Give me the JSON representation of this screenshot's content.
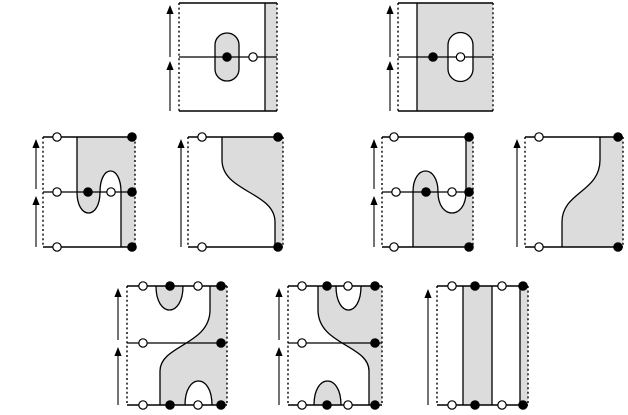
{
  "figure": {
    "title": "cobordism-diagram-figure",
    "canvas": {
      "width": 628,
      "height": 415
    },
    "colors": {
      "background": "#ffffff",
      "shade": "#dcdcdc",
      "stroke": "#000000",
      "open_dot_fill": "#ffffff",
      "filled_dot_fill": "#000000"
    },
    "style": {
      "edge_stroke_width": 1.4,
      "curve_stroke_width": 1.3,
      "dash_pattern": "2 2.6",
      "dot_radius": 4.2,
      "dot_stroke_width": 1.2,
      "arrow_stroke_width": 1.1,
      "arrow_head_half_width": 3.6,
      "arrow_head_length": 9
    },
    "panels": [
      {
        "name": "panel-top-left-dotted-capsule",
        "box": {
          "x": 179,
          "y": 3,
          "w": 98,
          "h": 108
        },
        "middle_line_y": 57,
        "shaded_paths": [
          "M265,3 H277 V111 H265 Z",
          "M215,45 A12 12 0 0 1 239,45 L239,69 A12 12 0 0 1 215,69 Z"
        ],
        "white_paths": [],
        "curve_paths": [
          "M215,45 A12 12 0 0 1 239,45 L239,69 A12 12 0 0 1 215,69 Z",
          "M265,3 V111"
        ],
        "dots": [
          {
            "x": 227,
            "y": 57,
            "type": "filled"
          },
          {
            "x": 253,
            "y": 57,
            "type": "open"
          }
        ],
        "arrows": [
          {
            "x": 170,
            "base": 57,
            "tip": 5
          },
          {
            "x": 170,
            "base": 111,
            "tip": 61
          }
        ]
      },
      {
        "name": "panel-top-right-white-capsule",
        "box": {
          "x": 398,
          "y": 3,
          "w": 95,
          "h": 108
        },
        "middle_line_y": 57,
        "shaded_paths": [
          "M417,3 H493 V111 H417 Z"
        ],
        "white_paths": [
          "M448,45 A12.5 12.5 0 0 1 473,45 L473,69 A12.5 12.5 0 0 1 448,69 Z"
        ],
        "curve_paths": [
          "M448,45 A12.5 12.5 0 0 1 473,45 L473,69 A12.5 12.5 0 0 1 448,69 Z",
          "M417,3 V111"
        ],
        "dots": [
          {
            "x": 433,
            "y": 57,
            "type": "filled"
          },
          {
            "x": 460.5,
            "y": 57,
            "type": "open"
          }
        ],
        "arrows": [
          {
            "x": 390,
            "base": 57,
            "tip": 5
          },
          {
            "x": 390,
            "base": 111,
            "tip": 61
          }
        ]
      },
      {
        "name": "panel-middle-1-snake-cup-cap",
        "box": {
          "x": 43,
          "y": 137,
          "w": 92,
          "h": 110
        },
        "middle_line_y": 192,
        "shaded_paths": [
          "M77,137 V192 C77,220 100,220 100,192 C100,164 121,164 121,192 V247 H135 V137 Z"
        ],
        "white_paths": [],
        "curve_paths": [
          "M77,137 V192 C77,220 100,220 100,192 C100,164 121,164 121,192 V247"
        ],
        "dots": [
          {
            "x": 57,
            "y": 137,
            "type": "open"
          },
          {
            "x": 132,
            "y": 137,
            "type": "filled"
          },
          {
            "x": 57,
            "y": 247,
            "type": "open"
          },
          {
            "x": 132,
            "y": 247,
            "type": "filled"
          },
          {
            "x": 57,
            "y": 192,
            "type": "open"
          },
          {
            "x": 88,
            "y": 192,
            "type": "filled"
          },
          {
            "x": 111,
            "y": 192,
            "type": "open"
          },
          {
            "x": 132,
            "y": 192,
            "type": "filled"
          }
        ],
        "arrows": [
          {
            "x": 36,
            "base": 189,
            "tip": 139
          },
          {
            "x": 36,
            "base": 247,
            "tip": 196
          }
        ]
      },
      {
        "name": "panel-middle-2-s-curve",
        "box": {
          "x": 188,
          "y": 137,
          "w": 95,
          "h": 110
        },
        "middle_line_y": null,
        "shaded_paths": [
          "M222,137 V160 C222,192 275,192 275,222 V247 H283 V137 Z"
        ],
        "white_paths": [],
        "curve_paths": [
          "M222,137 V160 C222,192 275,192 275,222 V247"
        ],
        "dots": [
          {
            "x": 202,
            "y": 137,
            "type": "open"
          },
          {
            "x": 278,
            "y": 137,
            "type": "filled"
          },
          {
            "x": 202,
            "y": 247,
            "type": "open"
          },
          {
            "x": 278,
            "y": 247,
            "type": "filled"
          }
        ],
        "arrows": [
          {
            "x": 181,
            "base": 247,
            "tip": 139
          }
        ]
      },
      {
        "name": "panel-middle-3-snake-cap-cup",
        "box": {
          "x": 382,
          "y": 137,
          "w": 91,
          "h": 110
        },
        "middle_line_y": 192,
        "shaded_paths": [
          "M413,247 V192 C413,164 438,164 438,192 C438,220 466,220 466,192 V137 H473 V247 Z"
        ],
        "white_paths": [],
        "curve_paths": [
          "M413,247 V192 C413,164 438,164 438,192 C438,220 466,220 466,192 V137"
        ],
        "dots": [
          {
            "x": 394,
            "y": 137,
            "type": "open"
          },
          {
            "x": 469,
            "y": 137,
            "type": "filled"
          },
          {
            "x": 394,
            "y": 247,
            "type": "open"
          },
          {
            "x": 469,
            "y": 247,
            "type": "filled"
          },
          {
            "x": 396,
            "y": 192,
            "type": "open"
          },
          {
            "x": 426,
            "y": 192,
            "type": "filled"
          },
          {
            "x": 452,
            "y": 192,
            "type": "open"
          },
          {
            "x": 469,
            "y": 192,
            "type": "filled"
          }
        ],
        "arrows": [
          {
            "x": 374,
            "base": 189,
            "tip": 139
          },
          {
            "x": 374,
            "base": 247,
            "tip": 196
          }
        ]
      },
      {
        "name": "panel-middle-4-reverse-s-curve",
        "box": {
          "x": 525,
          "y": 137,
          "w": 98,
          "h": 110
        },
        "middle_line_y": null,
        "shaded_paths": [
          "M600,137 V160 C600,192 562,192 562,222 V247 H623 V137 Z"
        ],
        "white_paths": [],
        "curve_paths": [
          "M600,137 V160 C600,192 562,192 562,222 V247"
        ],
        "dots": [
          {
            "x": 539,
            "y": 137,
            "type": "open"
          },
          {
            "x": 618,
            "y": 137,
            "type": "filled"
          },
          {
            "x": 539,
            "y": 247,
            "type": "open"
          },
          {
            "x": 618,
            "y": 247,
            "type": "filled"
          }
        ],
        "arrows": [
          {
            "x": 517,
            "base": 247,
            "tip": 139
          }
        ]
      },
      {
        "name": "panel-bottom-1-s-with-cup-cap",
        "box": {
          "x": 127,
          "y": 286,
          "w": 100,
          "h": 119
        },
        "middle_line_y": 343,
        "shaded_paths": [
          "M210,286 V310 C210,345 160,345 160,371 V405 H227 V286 Z",
          "M156,286 C156,318 183,318 183,286 Z"
        ],
        "white_paths": [
          "M185,405 C185,373 212,373 212,405 Z"
        ],
        "curve_paths": [
          "M210,286 V310 C210,345 160,345 160,371 V405",
          "M156,286 C156,318 183,318 183,286",
          "M185,405 C185,373 212,373 212,405"
        ],
        "dots": [
          {
            "x": 143,
            "y": 286,
            "type": "open"
          },
          {
            "x": 170,
            "y": 286,
            "type": "filled"
          },
          {
            "x": 198,
            "y": 286,
            "type": "open"
          },
          {
            "x": 221,
            "y": 286,
            "type": "filled"
          },
          {
            "x": 143,
            "y": 405,
            "type": "open"
          },
          {
            "x": 170,
            "y": 405,
            "type": "filled"
          },
          {
            "x": 198,
            "y": 405,
            "type": "open"
          },
          {
            "x": 221,
            "y": 405,
            "type": "filled"
          },
          {
            "x": 143,
            "y": 343,
            "type": "open"
          },
          {
            "x": 221,
            "y": 343,
            "type": "filled"
          }
        ],
        "arrows": [
          {
            "x": 118,
            "base": 340,
            "tip": 288
          },
          {
            "x": 118,
            "base": 405,
            "tip": 347
          }
        ]
      },
      {
        "name": "panel-bottom-2-s-with-cup-cap-mirrored",
        "box": {
          "x": 288,
          "y": 286,
          "w": 94,
          "h": 119
        },
        "middle_line_y": 343,
        "shaded_paths": [
          "M318,286 V310 C318,345 369,345 369,371 V405 H382 V286 Z",
          "M314,405 C314,373 341,373 341,405 Z"
        ],
        "white_paths": [
          "M336,286 C336,318 361,318 361,286 Z"
        ],
        "curve_paths": [
          "M318,286 V310 C318,345 369,345 369,371 V405",
          "M336,286 C336,318 361,318 361,286",
          "M314,405 C314,373 341,373 341,405"
        ],
        "dots": [
          {
            "x": 302,
            "y": 286,
            "type": "open"
          },
          {
            "x": 327,
            "y": 286,
            "type": "filled"
          },
          {
            "x": 348,
            "y": 286,
            "type": "open"
          },
          {
            "x": 375,
            "y": 286,
            "type": "filled"
          },
          {
            "x": 302,
            "y": 405,
            "type": "open"
          },
          {
            "x": 327,
            "y": 405,
            "type": "filled"
          },
          {
            "x": 348,
            "y": 405,
            "type": "open"
          },
          {
            "x": 375,
            "y": 405,
            "type": "filled"
          },
          {
            "x": 302,
            "y": 343,
            "type": "open"
          },
          {
            "x": 375,
            "y": 343,
            "type": "filled"
          }
        ],
        "arrows": [
          {
            "x": 279,
            "base": 340,
            "tip": 288
          },
          {
            "x": 279,
            "base": 405,
            "tip": 347
          }
        ]
      },
      {
        "name": "panel-bottom-3-vertical-strips",
        "box": {
          "x": 437,
          "y": 286,
          "w": 91,
          "h": 119
        },
        "middle_line_y": null,
        "shaded_paths": [
          "M463,286 H492 V405 H463 Z",
          "M520,286 H528 V405 H520 Z"
        ],
        "white_paths": [],
        "curve_paths": [
          "M463,286 V405",
          "M492,286 V405",
          "M520,286 V405"
        ],
        "dots": [
          {
            "x": 452,
            "y": 286,
            "type": "open"
          },
          {
            "x": 475,
            "y": 286,
            "type": "filled"
          },
          {
            "x": 502,
            "y": 286,
            "type": "open"
          },
          {
            "x": 523,
            "y": 286,
            "type": "filled"
          },
          {
            "x": 452,
            "y": 405,
            "type": "open"
          },
          {
            "x": 475,
            "y": 405,
            "type": "filled"
          },
          {
            "x": 502,
            "y": 405,
            "type": "open"
          },
          {
            "x": 523,
            "y": 405,
            "type": "filled"
          }
        ],
        "arrows": [
          {
            "x": 428,
            "base": 405,
            "tip": 289
          }
        ]
      }
    ]
  }
}
